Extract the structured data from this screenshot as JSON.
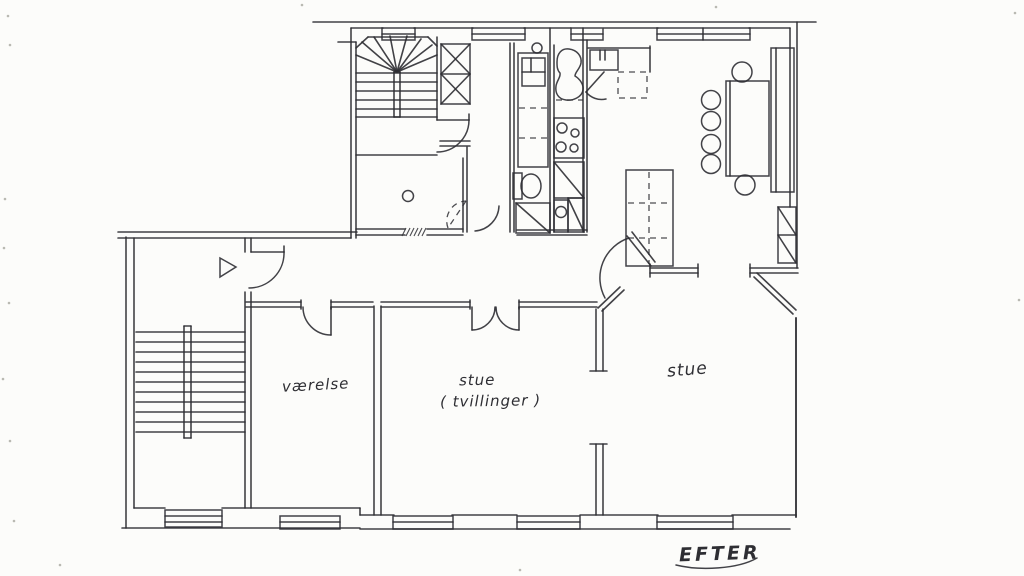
{
  "title": "hand-drawn apartment floor plan",
  "colors": {
    "paper": "#fcfcfa",
    "ink": "#2e2e33",
    "speck": "#b9b9b2"
  },
  "labels": {
    "room1": {
      "text": "værelse",
      "x": 282,
      "y": 376,
      "size": 15,
      "rot": -3
    },
    "room2a": {
      "text": "stue",
      "x": 459,
      "y": 371,
      "size": 15,
      "rot": -1
    },
    "room2b": {
      "text": "( tvillinger )",
      "x": 440,
      "y": 392,
      "size": 15,
      "rot": -1
    },
    "room3": {
      "text": "stue",
      "x": 667,
      "y": 360,
      "size": 17,
      "rot": -5
    },
    "caption": {
      "text": "EFTER",
      "x": 679,
      "y": 543,
      "size": 19,
      "rot": -2
    }
  },
  "plan": {
    "lines": [
      [
        313,
        22,
        816,
        22
      ],
      [
        351,
        28,
        383,
        28
      ],
      [
        414,
        28,
        473,
        28
      ],
      [
        524,
        28,
        571,
        28
      ],
      [
        604,
        28,
        658,
        28
      ],
      [
        749,
        28,
        790,
        28
      ],
      [
        790,
        28,
        790,
        207
      ],
      [
        797,
        22,
        797,
        268
      ],
      [
        650,
        268,
        698,
        268
      ],
      [
        650,
        273,
        698,
        273
      ],
      [
        750,
        268,
        798,
        268
      ],
      [
        750,
        273,
        798,
        273
      ],
      [
        650,
        264,
        650,
        277
      ],
      [
        698,
        264,
        698,
        277
      ],
      [
        750,
        264,
        750,
        277
      ],
      [
        754,
        277,
        793,
        314
      ],
      [
        757,
        273,
        796,
        310
      ],
      [
        796,
        318,
        796,
        517,
        2
      ],
      [
        134,
        508,
        165,
        508
      ],
      [
        222,
        508,
        360,
        508
      ],
      [
        360,
        508,
        360,
        515
      ],
      [
        360,
        515,
        394,
        515
      ],
      [
        452,
        515,
        517,
        515
      ],
      [
        580,
        515,
        658,
        515
      ],
      [
        732,
        515,
        796,
        515
      ],
      [
        122,
        528,
        360,
        528
      ],
      [
        360,
        529,
        790,
        529
      ],
      [
        126,
        237,
        126,
        528
      ],
      [
        134,
        238,
        134,
        508
      ],
      [
        118,
        232,
        357,
        232
      ],
      [
        118,
        238,
        351,
        238
      ],
      [
        245,
        238,
        245,
        252
      ],
      [
        245,
        292,
        245,
        508
      ],
      [
        251,
        238,
        251,
        252
      ],
      [
        251,
        292,
        251,
        508
      ],
      [
        251,
        252,
        284,
        252
      ],
      [
        284,
        246,
        284,
        252
      ],
      [
        351,
        28,
        351,
        238
      ],
      [
        356,
        42,
        356,
        238
      ],
      [
        338,
        42,
        356,
        42
      ],
      [
        437,
        37,
        437,
        120
      ],
      [
        356,
        48,
        368,
        37
      ],
      [
        368,
        37,
        428,
        37
      ],
      [
        428,
        37,
        437,
        46
      ],
      [
        397,
        72,
        356,
        55
      ],
      [
        397,
        72,
        362,
        42
      ],
      [
        397,
        72,
        374,
        37
      ],
      [
        397,
        72,
        390,
        36
      ],
      [
        397,
        72,
        407,
        36
      ],
      [
        397,
        72,
        421,
        39
      ],
      [
        397,
        72,
        432,
        45
      ],
      [
        397,
        72,
        437,
        55
      ],
      [
        356,
        73,
        437,
        73
      ],
      [
        356,
        82,
        437,
        82
      ],
      [
        356,
        91,
        437,
        91
      ],
      [
        356,
        100,
        437,
        100
      ],
      [
        356,
        109,
        437,
        109
      ],
      [
        356,
        117,
        437,
        117
      ],
      [
        356,
        155,
        437,
        155
      ],
      [
        394,
        72,
        394,
        117
      ],
      [
        400,
        72,
        400,
        117
      ],
      [
        394,
        72,
        400,
        72
      ],
      [
        394,
        117,
        400,
        117
      ],
      [
        463,
        158,
        463,
        232
      ],
      [
        467,
        147,
        467,
        232
      ],
      [
        356,
        229,
        405,
        229
      ],
      [
        427,
        229,
        463,
        229
      ],
      [
        356,
        235,
        405,
        235
      ],
      [
        427,
        235,
        463,
        235
      ],
      [
        517,
        230,
        587,
        230
      ],
      [
        517,
        235,
        587,
        235
      ],
      [
        440,
        141,
        470,
        141
      ],
      [
        440,
        146,
        470,
        146
      ],
      [
        437,
        120,
        469,
        120
      ],
      [
        469,
        114,
        469,
        120
      ],
      [
        441,
        74,
        470,
        74
      ],
      [
        441,
        44,
        470,
        74
      ],
      [
        470,
        44,
        441,
        74
      ],
      [
        441,
        74,
        470,
        104
      ],
      [
        470,
        74,
        441,
        104
      ],
      [
        510,
        43,
        510,
        232
      ],
      [
        514,
        43,
        514,
        232
      ],
      [
        550,
        28,
        550,
        232
      ],
      [
        554,
        45,
        554,
        232
      ],
      [
        583,
        28,
        583,
        232
      ],
      [
        587,
        40,
        587,
        232
      ],
      [
        522,
        72,
        545,
        72
      ],
      [
        531,
        58,
        531,
        72
      ],
      [
        588,
        48,
        650,
        48
      ],
      [
        650,
        46,
        650,
        72
      ],
      [
        600,
        50,
        600,
        60
      ],
      [
        605,
        50,
        605,
        60
      ],
      [
        604,
        72,
        586,
        92
      ],
      [
        554,
        162,
        584,
        198
      ],
      [
        568,
        198,
        584,
        232
      ],
      [
        516,
        203,
        550,
        233
      ],
      [
        627,
        236,
        651,
        266
      ],
      [
        632,
        232,
        655,
        262
      ],
      [
        598,
        308,
        620,
        287
      ],
      [
        602,
        311,
        624,
        290
      ],
      [
        246,
        302,
        301,
        302
      ],
      [
        331,
        302,
        373,
        302
      ],
      [
        381,
        302,
        470,
        302
      ],
      [
        519,
        302,
        597,
        302
      ],
      [
        246,
        307,
        301,
        307
      ],
      [
        331,
        307,
        373,
        307
      ],
      [
        381,
        307,
        470,
        307
      ],
      [
        519,
        307,
        597,
        307
      ],
      [
        301,
        300,
        301,
        309
      ],
      [
        331,
        300,
        331,
        309
      ],
      [
        470,
        300,
        470,
        309
      ],
      [
        519,
        300,
        519,
        309
      ],
      [
        331,
        307,
        331,
        335
      ],
      [
        472,
        307,
        472,
        330
      ],
      [
        519,
        307,
        519,
        330
      ],
      [
        374,
        306,
        374,
        515
      ],
      [
        381,
        306,
        381,
        515
      ],
      [
        596,
        309,
        596,
        371
      ],
      [
        603,
        309,
        603,
        371
      ],
      [
        590,
        371,
        607,
        371
      ],
      [
        596,
        444,
        596,
        515
      ],
      [
        603,
        444,
        603,
        515
      ],
      [
        590,
        444,
        607,
        444
      ],
      [
        136,
        332,
        245,
        332
      ],
      [
        136,
        342,
        245,
        342
      ],
      [
        136,
        352,
        245,
        352
      ],
      [
        136,
        362,
        245,
        362
      ],
      [
        136,
        372,
        245,
        372
      ],
      [
        136,
        382,
        245,
        382
      ],
      [
        136,
        392,
        245,
        392
      ],
      [
        136,
        402,
        245,
        402
      ],
      [
        136,
        412,
        245,
        412
      ],
      [
        136,
        422,
        245,
        422
      ],
      [
        136,
        432,
        245,
        432
      ],
      [
        184,
        326,
        184,
        438
      ],
      [
        191,
        326,
        191,
        438
      ],
      [
        184,
        326,
        191,
        326
      ],
      [
        184,
        438,
        191,
        438
      ],
      [
        165,
        516,
        222,
        516
      ],
      [
        165,
        522,
        222,
        522
      ],
      [
        280,
        522,
        340,
        522
      ],
      [
        393,
        522,
        453,
        522
      ],
      [
        517,
        522,
        580,
        522
      ],
      [
        657,
        522,
        733,
        522
      ],
      [
        382,
        34,
        415,
        34
      ],
      [
        472,
        34,
        525,
        34
      ],
      [
        571,
        34,
        603,
        34
      ],
      [
        657,
        34,
        750,
        34
      ],
      [
        703,
        28,
        703,
        40
      ],
      [
        730,
        81,
        730,
        176
      ],
      [
        776,
        48,
        776,
        192
      ],
      [
        778,
        235,
        796,
        235
      ],
      [
        778,
        207,
        796,
        235
      ],
      [
        778,
        235,
        796,
        263
      ]
    ],
    "dashed": [
      [
        519,
        108,
        547,
        108
      ],
      [
        519,
        138,
        547,
        138
      ],
      [
        556,
        100,
        583,
        100
      ],
      [
        649,
        172,
        649,
        264
      ],
      [
        628,
        203,
        671,
        203
      ],
      [
        628,
        238,
        671,
        238
      ],
      [
        466,
        201,
        448,
        228
      ]
    ],
    "hatch": [
      [
        406,
        228,
        402,
        236
      ],
      [
        410,
        228,
        406,
        236
      ],
      [
        414,
        228,
        410,
        236
      ],
      [
        418,
        228,
        414,
        236
      ],
      [
        422,
        228,
        418,
        236
      ],
      [
        426,
        228,
        422,
        236
      ]
    ],
    "rects": [
      [
        441,
        44,
        29,
        60
      ],
      [
        518,
        53,
        30,
        114
      ],
      [
        522,
        58,
        23,
        28
      ],
      [
        554,
        118,
        30,
        40
      ],
      [
        554,
        162,
        30,
        36
      ],
      [
        554,
        200,
        14,
        32
      ],
      [
        568,
        198,
        16,
        34
      ],
      [
        513,
        173,
        9,
        26
      ],
      [
        516,
        203,
        34,
        30
      ],
      [
        590,
        50,
        28,
        20
      ],
      [
        626,
        170,
        47,
        96
      ],
      [
        726,
        81,
        43,
        95
      ],
      [
        771,
        48,
        23,
        144
      ],
      [
        778,
        207,
        18,
        56
      ],
      [
        165,
        510,
        57,
        17
      ],
      [
        280,
        516,
        60,
        13
      ],
      [
        393,
        516,
        60,
        13
      ],
      [
        517,
        516,
        63,
        13
      ],
      [
        657,
        516,
        76,
        13
      ],
      [
        382,
        28,
        33,
        12
      ],
      [
        472,
        28,
        53,
        12
      ],
      [
        571,
        28,
        32,
        12
      ],
      [
        657,
        28,
        93,
        12
      ]
    ],
    "dashed_rects": [
      [
        618,
        72,
        29,
        26
      ]
    ],
    "circles": [
      [
        537,
        48,
        5
      ],
      [
        408,
        196,
        5.5
      ],
      [
        561,
        212,
        5.5
      ],
      [
        562,
        128,
        5
      ],
      [
        575,
        133,
        4
      ],
      [
        561,
        147,
        5
      ],
      [
        574,
        148,
        4
      ],
      [
        711,
        100,
        9.5
      ],
      [
        711,
        121,
        9.5
      ],
      [
        711,
        144,
        9.5
      ],
      [
        711,
        164,
        9.5
      ],
      [
        742,
        72,
        10
      ],
      [
        745,
        185,
        10
      ]
    ],
    "ellipses": [
      [
        531,
        186,
        10,
        12
      ]
    ],
    "paths": [
      "M557,62 C557,53 562,48 569,49 C577,50 582,56 581,63 C580,69 575,72 575,76 C580,79 584,85 583,90 C582,97 573,101 566,100 C558,99 555,93 556,86 C557,80 561,77 560,73 C557,70 557,66 557,62 Z",
      "M220,258 L220,277 L236,267 Z",
      "M284,252 A35,35 0 0 1 249,288",
      "M469,120 A32,32 0 0 1 437,152",
      "M499,206 A26,26 0 0 1 475,231",
      "M303,307 A28,28 0 0 0 331,335",
      "M495,307 A23,23 0 0 1 472,330",
      "M496,307 A23,23 0 0 0 519,330",
      "M629,238 A42,42 0 0 0 605,298",
      "M586,92 A20,20 0 0 0 606,99",
      "M676,565 C700,571 738,569 757,558"
    ],
    "dashed_paths": [
      "M448,228 A20,20 0 0 1 466,201"
    ],
    "specks": [
      [
        8,
        16
      ],
      [
        10,
        45
      ],
      [
        5,
        199
      ],
      [
        4,
        248
      ],
      [
        9,
        303
      ],
      [
        3,
        379
      ],
      [
        10,
        441
      ],
      [
        14,
        521
      ],
      [
        302,
        5
      ],
      [
        716,
        7
      ],
      [
        1015,
        13
      ],
      [
        1019,
        300
      ],
      [
        520,
        570
      ],
      [
        60,
        565
      ]
    ]
  }
}
